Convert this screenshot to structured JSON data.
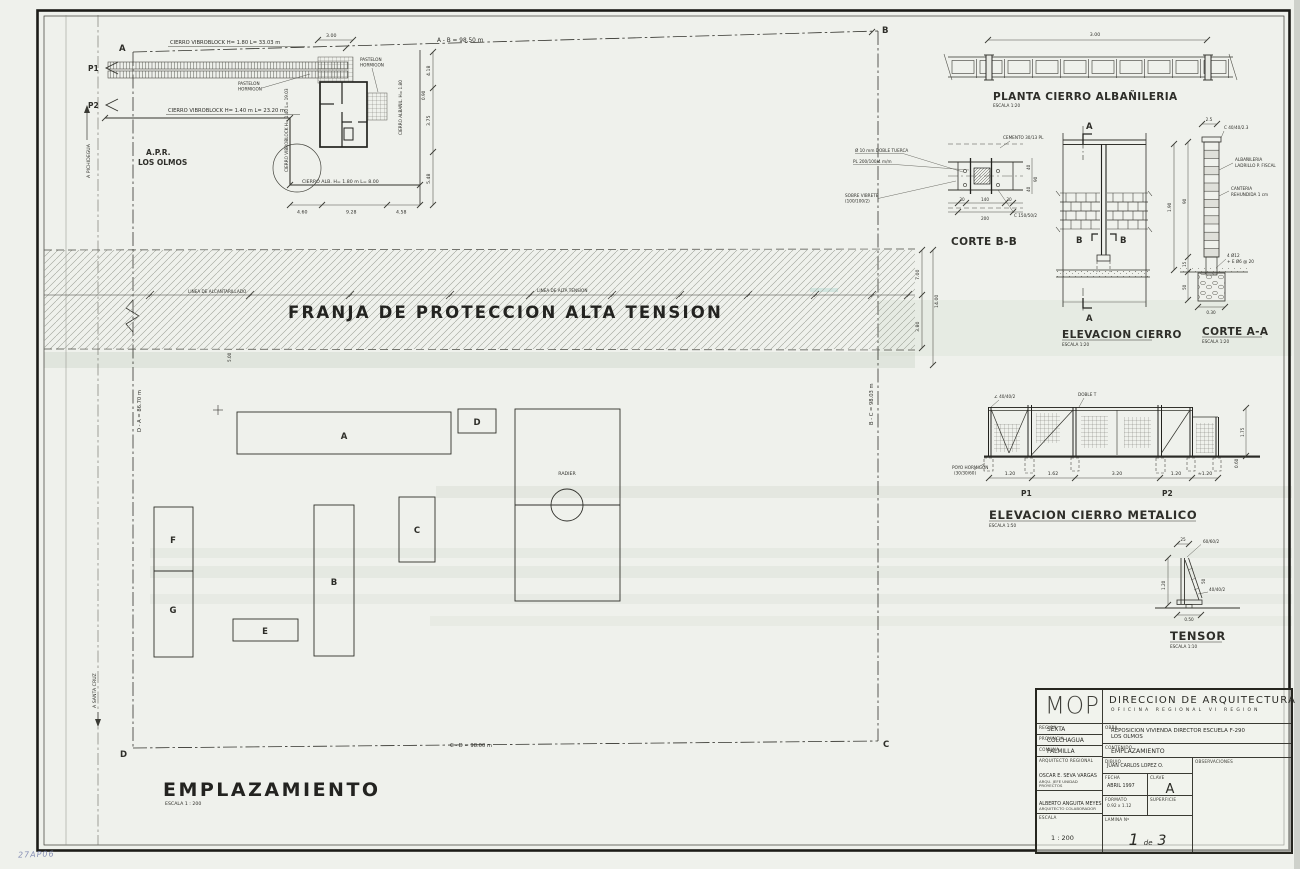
{
  "sheet": {
    "handwritten_note": "27AP06",
    "corners": {
      "a": "A",
      "b": "B",
      "c": "C",
      "d": "D"
    },
    "roads": {
      "pichidegua": "A  PICHIDEGUA",
      "santa_cruz": "A  SANTA CRUZ"
    },
    "points": {
      "p1": "P1",
      "p2": "P2"
    },
    "boundary_dims": {
      "ab": "A - B = 98.50 m",
      "bc": "B - C = 98.03 m",
      "cd": "C - D = 98.00 m",
      "da": "D - A = 86.70 m"
    }
  },
  "apr": {
    "fence_top": "CIERRO VIBROBLOCK   H= 1.80   L= 33.03 m",
    "fence_mid": "CIERRO VIBROBLOCK   H= 1.40 m   L= 23.20 m",
    "fence_vert": "CIERRO VIBROBLOCK  H= 1.40   L= 19.03",
    "fence_alb": "CIERRO ALB.  H= 1.80 m   L= 8.00",
    "fence_alb_right": "CIERRO ALBAÑIL.  H= 1.80",
    "site_name_1": "A.P.R.",
    "site_name_2": "LOS OLMOS",
    "pav_label_1a": "PASTELON",
    "pav_label_1b": "HORMIGON",
    "pav_label_2a": "PASTELON",
    "pav_label_2b": "HORMIGON",
    "dim_top": "3.00",
    "dim_small": "0.90",
    "dims_right": [
      "4.18",
      "3.75",
      "5.48"
    ],
    "dims_bottom": [
      "4.60",
      "9.28",
      "4.58"
    ]
  },
  "franja": {
    "title": "FRANJA  DE  PROTECCION  ALTA  TENSION",
    "line_left": "LINEA DE ALCANTARILLADO",
    "line_right": "LINEA DE ALTA TENSION",
    "dims": {
      "upper": "7.00",
      "total": "14.00",
      "lower": "3.80",
      "offset": "5.00"
    }
  },
  "plan": {
    "title": "EMPLAZAMIENTO",
    "scale": "ESCALA 1 : 200",
    "buildings": [
      "A",
      "B",
      "C",
      "D",
      "E",
      "F",
      "G"
    ],
    "radier": "RADIER"
  },
  "planta_cierro": {
    "title": "PLANTA CIERRO ALBAÑILERIA",
    "scale": "ESCALA 1:20",
    "dim": "3.00"
  },
  "corte_bb": {
    "title": "CORTE B-B",
    "label_tuerca": "Ø 10 mm DOBLE TUERCA",
    "label_plancha": "PL 200/100/4 m/m",
    "label_sobre_1": "SOBRE VIBRETE",
    "label_sobre_2": "(100/100/2)",
    "label_cemento": "CEMENTO 30/13 PL",
    "label_perfil": "C 150/50/2",
    "dims_bottom": [
      "30",
      "140",
      "30"
    ],
    "dim_total": "200",
    "dims_right": [
      "40",
      "90",
      "40"
    ]
  },
  "elev_cierro": {
    "title": "ELEVACION CIERRO",
    "scale": "ESCALA 1:20",
    "marker_a": "A",
    "marker_b": "B",
    "dim_right": "1.90"
  },
  "corte_aa": {
    "title": "CORTE A-A",
    "scale": "ESCALA 1:20",
    "label_perfil": "C 40/40/2.3",
    "label_alba_1": "ALBAÑILERIA",
    "label_alba_2": "LADRILLO P. FISCAL",
    "label_canteria_1": "CANTERIA",
    "label_canteria_2": "REHUNDIDA 1 cm",
    "label_fierro_1": "4 Ø12",
    "label_fierro_2": "+ E Ø6 @ 20",
    "dim_top": "2.5",
    "dims_left": [
      "90",
      "15",
      "50"
    ],
    "dim_bottom": "0.30"
  },
  "elev_metalico": {
    "title": "ELEVACION CIERRO METALICO",
    "scale": "ESCALA 1:50",
    "label_angulo": "∠ 40/40/2",
    "label_doble_t": "DOBLE T",
    "label_poyo_1": "POYO HORMIGON",
    "label_poyo_2": "(30/30/60)",
    "p1": "P1",
    "p2": "P2",
    "dims_bottom": [
      "1.20",
      "1.62",
      "3.20",
      "1.20",
      "≈1.20"
    ],
    "dims_right": [
      "1.75",
      "0.60"
    ]
  },
  "tensor": {
    "title": "TENSOR",
    "scale": "ESCALA 1:10",
    "label_top": "60/60/2",
    "label_mid": "40/40/2",
    "dim_top": "25",
    "dim_left": "1.20",
    "dim_right": "50",
    "dim_bottom": "0.50"
  },
  "title_block": {
    "logo": "MOP",
    "org_title": "DIRECCION DE ARQUITECTURA",
    "org_subtitle": "OFICINA REGIONAL VI REGION",
    "region_label": "REGION",
    "region_value": "SEXTA",
    "provincia_label": "PROVINCIA",
    "provincia_value": "COLCHAGUA",
    "comuna_label": "COMUNA",
    "comuna_value": "PALMILLA",
    "arq_regional_label": "ARQUITECTO REGIONAL",
    "name_1": "OSCAR E. SEVA VARGAS",
    "role_1": "ARQU. JEFE UNIDAD PROYECTOS",
    "name_2": "ALBERTO ANGUITA MEYES",
    "role_2": "ARQUITECTO COLABORADOR",
    "escala_label": "ESCALA",
    "escala_value": "1 : 200",
    "obra_label": "OBRA",
    "obra_value_1": "REPOSICION VIVIENDA DIRECTOR ESCUELA F-290",
    "obra_value_2": "LOS OLMOS",
    "contenido_label": "CONTENIDO",
    "contenido_value": "EMPLAZAMIENTO",
    "dibujo_label": "DIBUJO",
    "dibujo_value": "JUAN CARLOS LOPEZ O.",
    "fecha_label": "FECHA",
    "fecha_value": "ABRIL 1997",
    "clave_label": "CLAVE",
    "clave_value": "A",
    "formato_label": "FORMATO",
    "formato_value": "0.92 x 1.12",
    "superficie_label": "SUPERFICIE",
    "lamina_label": "LAMINA Nº",
    "lamina_num": "1",
    "lamina_de": "de",
    "lamina_total": "3",
    "observaciones_label": "OBSERVACIONES"
  }
}
